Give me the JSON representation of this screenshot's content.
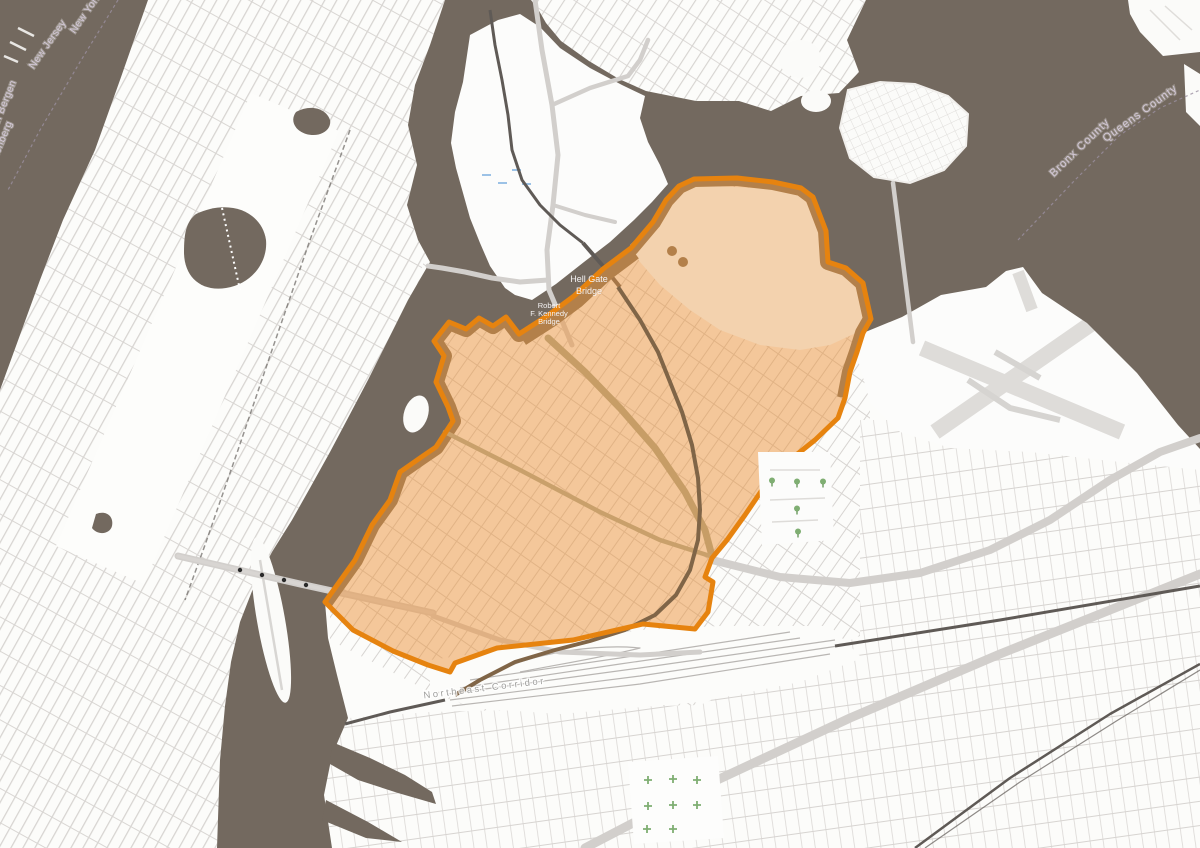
{
  "map": {
    "title": "Neighborhood highlight map (Astoria, Queens area)",
    "labels": {
      "new_jersey": "New Jersey",
      "new_york": "New York",
      "north_bergen": "North Bergen",
      "guttenberg": "Guttenberg",
      "bronx_county": "Bronx County",
      "queens_county": "Queens County",
      "hell_gate_line1": "Hell Gate",
      "hell_gate_line2": "Bridge",
      "rfk_line1": "Robert",
      "rfk_line2": "F. Kennedy",
      "rfk_line3": "Bridge",
      "northeast_corridor": "Northeast Corridor"
    },
    "colors": {
      "water": "#73695f",
      "land": "#fcfcfa",
      "street": "#d7d4d1",
      "highlight_fill": "#ec923a",
      "highlight_border": "#e6830f",
      "shore_band": "#b3804a",
      "industrial_patch": "#f3d2ae",
      "rail": "#5f5a56",
      "rail_in_highlight": "#806547",
      "parkway_tan": "#c79d66",
      "highway": "#d2cfcc",
      "cemetery_green": "#7fae72",
      "label_on_water": "#d5cada",
      "label_on_land": "#a0a09e",
      "label_bridge": "#f4f2f3"
    }
  }
}
